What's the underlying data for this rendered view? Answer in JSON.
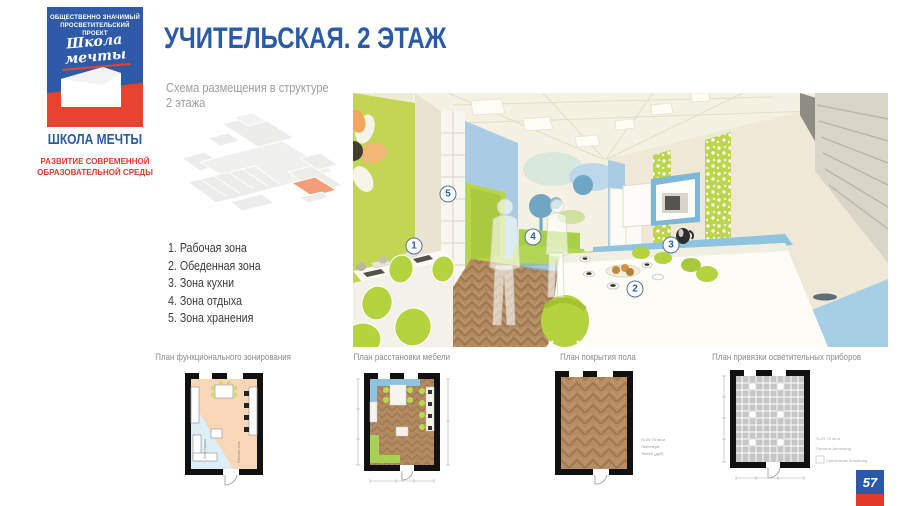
{
  "slide": {
    "title": "УЧИТЕЛЬСКАЯ. 2 ЭТАЖ",
    "subtitle_line1": "Схема размещения в структуре",
    "subtitle_line2": "2 этажа",
    "page_number": "57"
  },
  "logo": {
    "tagline_line1": "ОБЩЕСТВЕННО ЗНАЧИМЫЙ",
    "tagline_line2": "ПРОСВЕТИТЕЛЬСКИЙ ПРОЕКТ",
    "script_line1": "Школа",
    "script_line2": "мечты",
    "brand_name": "ШКОЛА МЕЧТЫ",
    "brand_sub_line1": "РАЗВИТИЕ СОВРЕМЕННОЙ",
    "brand_sub_line2": "ОБРАЗОВАТЕЛЬНОЙ СРЕДЫ"
  },
  "zones": {
    "items": [
      "1. Рабочая зона",
      "2. Обеденная зона",
      "3. Зона кухни",
      "4. Зона отдыха",
      "5. Зона хранения"
    ]
  },
  "render": {
    "markers": {
      "m1": "1",
      "m2": "2",
      "m3": "3",
      "m4": "4",
      "m5": "5"
    }
  },
  "plans": {
    "p1": {
      "caption": "План функционального зонирования",
      "label_rest": "Зона отдыха",
      "label_work": "Рабочая зона"
    },
    "p2": {
      "caption": "План расстановки мебели"
    },
    "p3": {
      "caption": "План покрытия пола",
      "note1": "S=29,70 кв.м",
      "note2": "Линолеум",
      "note3": "Tarkett (дуб)"
    },
    "p4": {
      "caption": "План привязки осветительных приборов",
      "legend1": "S=29,70 кв.м",
      "legend2": "Потолок Armstrong",
      "legend3": "Светильник Armstrong"
    }
  },
  "colors": {
    "accent_blue": "#2b5ba8",
    "accent_red": "#e2392b",
    "lime": "#bfd44e",
    "sky_blue": "#a9cce4",
    "cream": "#efe9d8",
    "wood": "#b28a60",
    "highlight_room": "#f49d78"
  }
}
